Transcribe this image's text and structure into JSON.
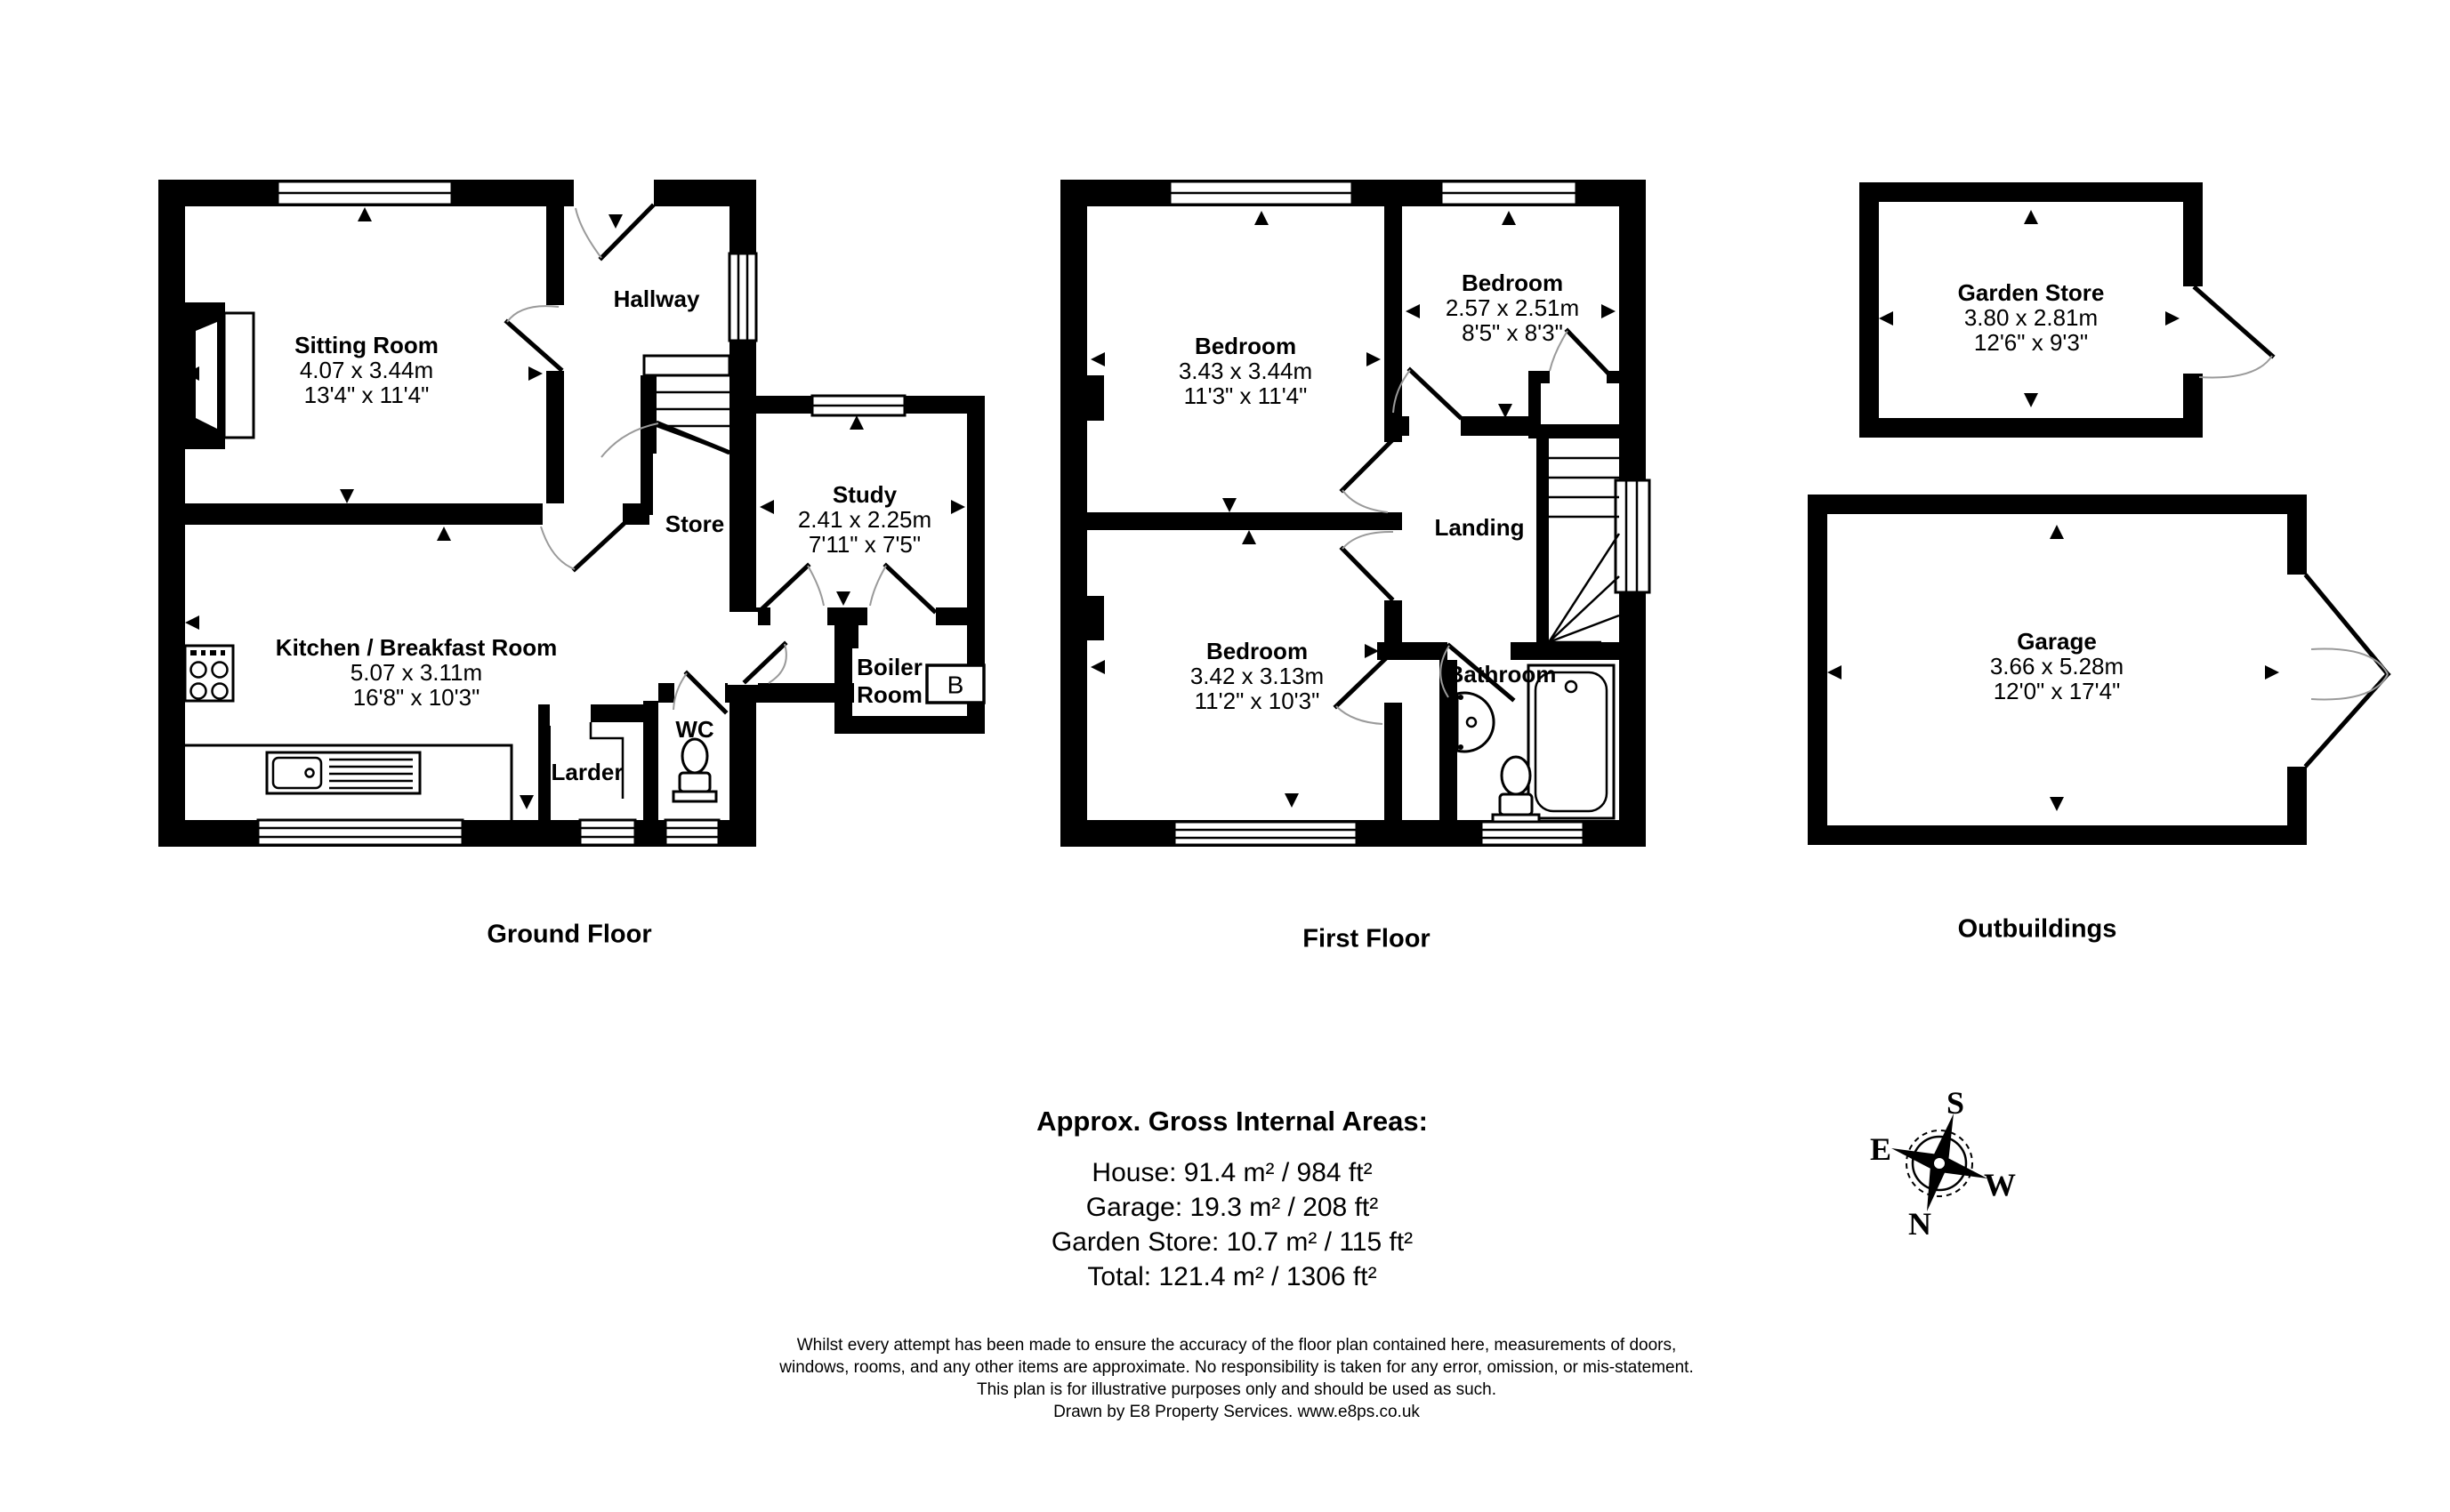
{
  "ground_floor": {
    "title": "Ground Floor",
    "rooms": {
      "sitting_room": {
        "name": "Sitting Room",
        "metric": "4.07 x 3.44m",
        "imperial": "13'4\" x 11'4\""
      },
      "hallway": {
        "name": "Hallway"
      },
      "store": {
        "name": "Store"
      },
      "study": {
        "name": "Study",
        "metric": "2.41 x 2.25m",
        "imperial": "7'11\" x 7'5\""
      },
      "kitchen": {
        "name": "Kitchen / Breakfast Room",
        "metric": "5.07 x 3.11m",
        "imperial": "16'8\" x 10'3\""
      },
      "boiler_room": {
        "name": "Boiler Room",
        "boiler_label": "B"
      },
      "wc": {
        "name": "WC"
      },
      "larder": {
        "name": "Larder"
      }
    }
  },
  "first_floor": {
    "title": "First Floor",
    "rooms": {
      "bedroom_1": {
        "name": "Bedroom",
        "metric": "3.43 x 3.44m",
        "imperial": "11'3\" x 11'4\""
      },
      "bedroom_2": {
        "name": "Bedroom",
        "metric": "2.57 x 2.51m",
        "imperial": "8'5\" x 8'3\""
      },
      "bedroom_3": {
        "name": "Bedroom",
        "metric": "3.42 x 3.13m",
        "imperial": "11'2\" x 10'3\""
      },
      "landing": {
        "name": "Landing"
      },
      "bathroom": {
        "name": "Bathroom"
      }
    }
  },
  "outbuildings": {
    "title": "Outbuildings",
    "rooms": {
      "garden_store": {
        "name": "Garden Store",
        "metric": "3.80 x 2.81m",
        "imperial": "12'6\" x 9'3\""
      },
      "garage": {
        "name": "Garage",
        "metric": "3.66 x 5.28m",
        "imperial": "12'0\" x 17'4\""
      }
    }
  },
  "areas": {
    "heading": "Approx. Gross Internal Areas:",
    "lines": [
      "House: 91.4 m² / 984 ft²",
      "Garage: 19.3 m² / 208 ft²",
      "Garden Store: 10.7 m² / 115 ft²",
      "Total: 121.4 m² / 1306 ft²"
    ]
  },
  "disclaimer": {
    "lines": [
      "Whilst every attempt has been made to ensure the accuracy of the floor plan contained here, measurements of doors,",
      "windows, rooms, and any other items are approximate. No responsibility is taken for any error, omission, or mis-statement.",
      "This plan is for illustrative purposes only and should be used as such.",
      "Drawn by E8 Property Services. www.e8ps.co.uk"
    ]
  },
  "compass": {
    "north": "N",
    "south": "S",
    "east": "E",
    "west": "W"
  }
}
